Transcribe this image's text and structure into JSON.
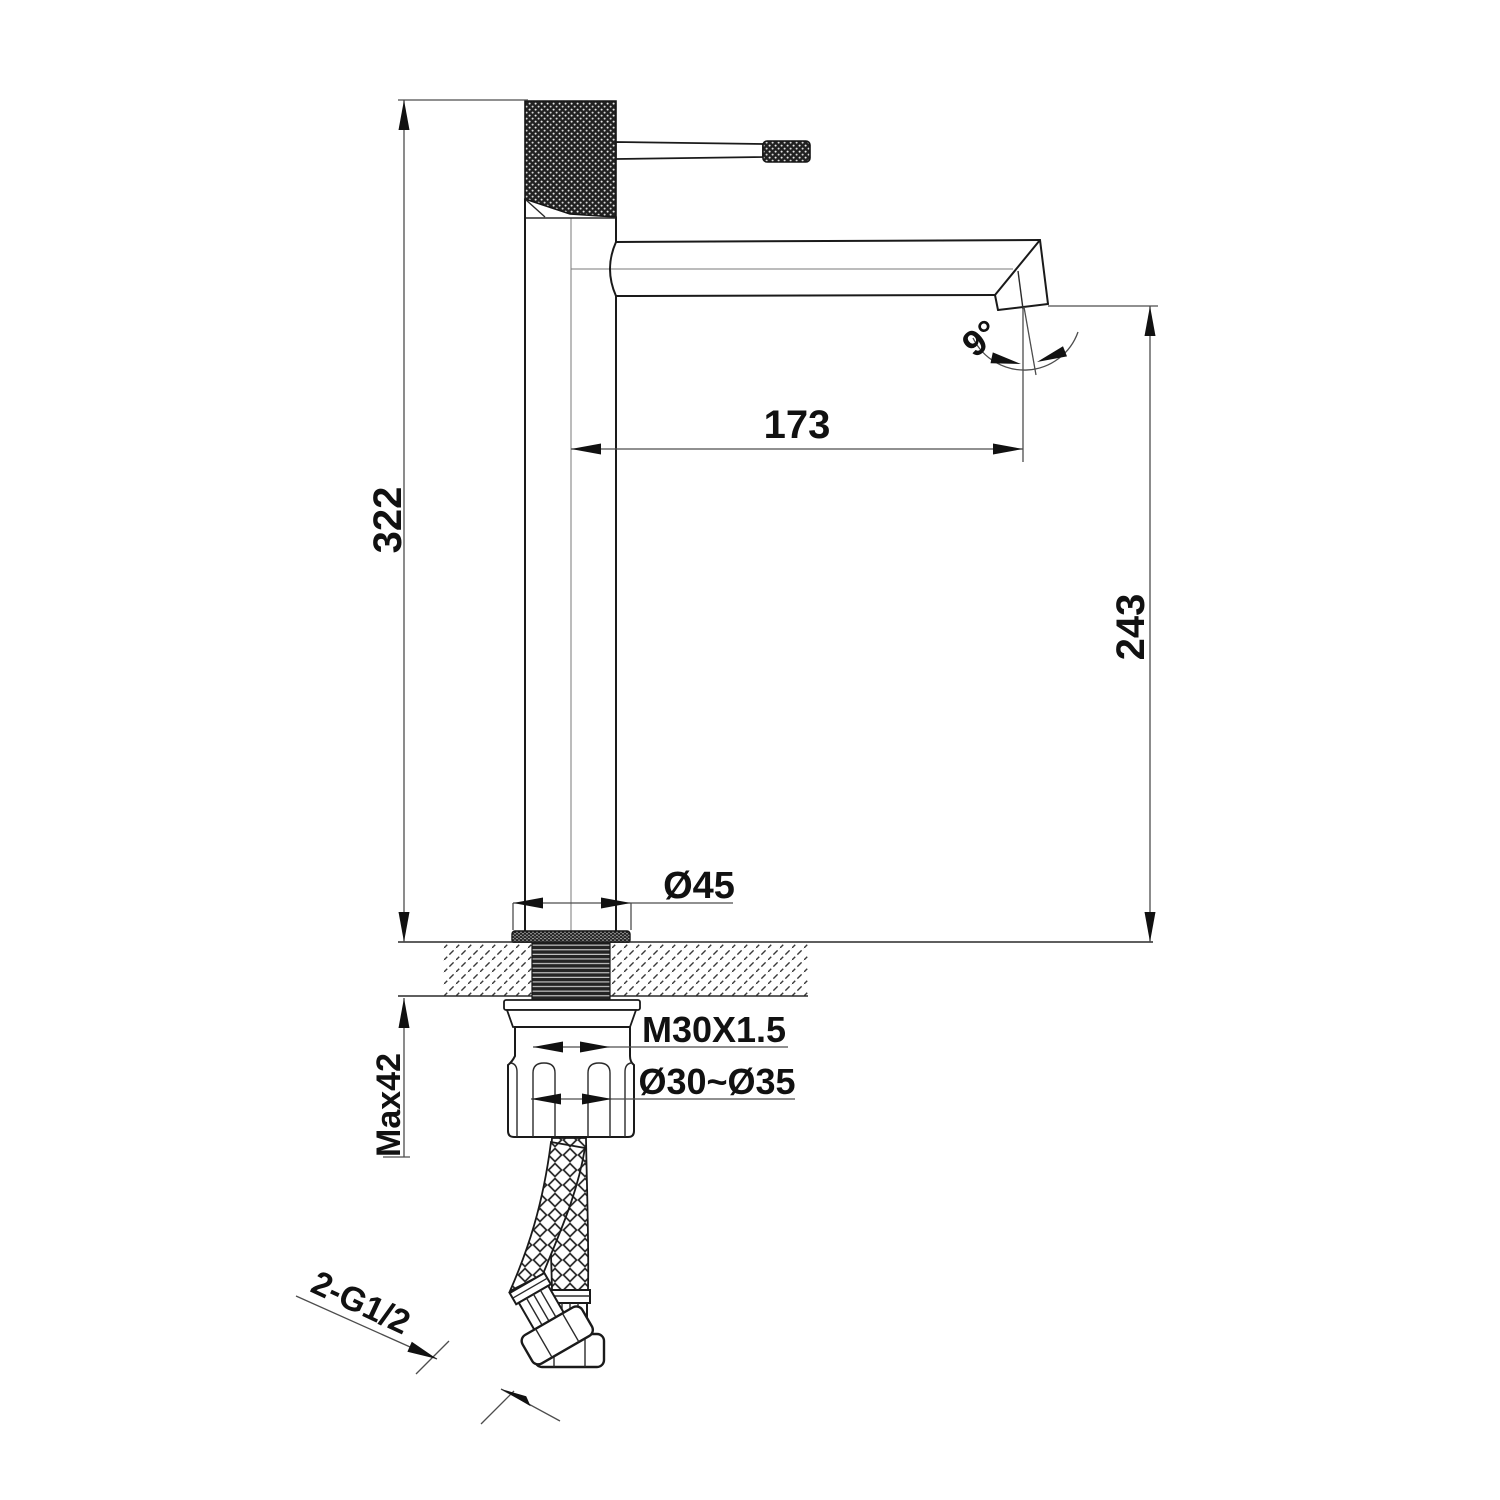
{
  "labels": {
    "overall_height": "322",
    "spout_reach": "173",
    "spout_outlet_height": "243",
    "spout_angle": "9°",
    "base_diameter": "Ø45",
    "thread_spec": "M30X1.5",
    "hole_diameter": "Ø30~Ø35",
    "max_deck_thickness": "Max42",
    "hose_connection": "2-G1/2"
  }
}
